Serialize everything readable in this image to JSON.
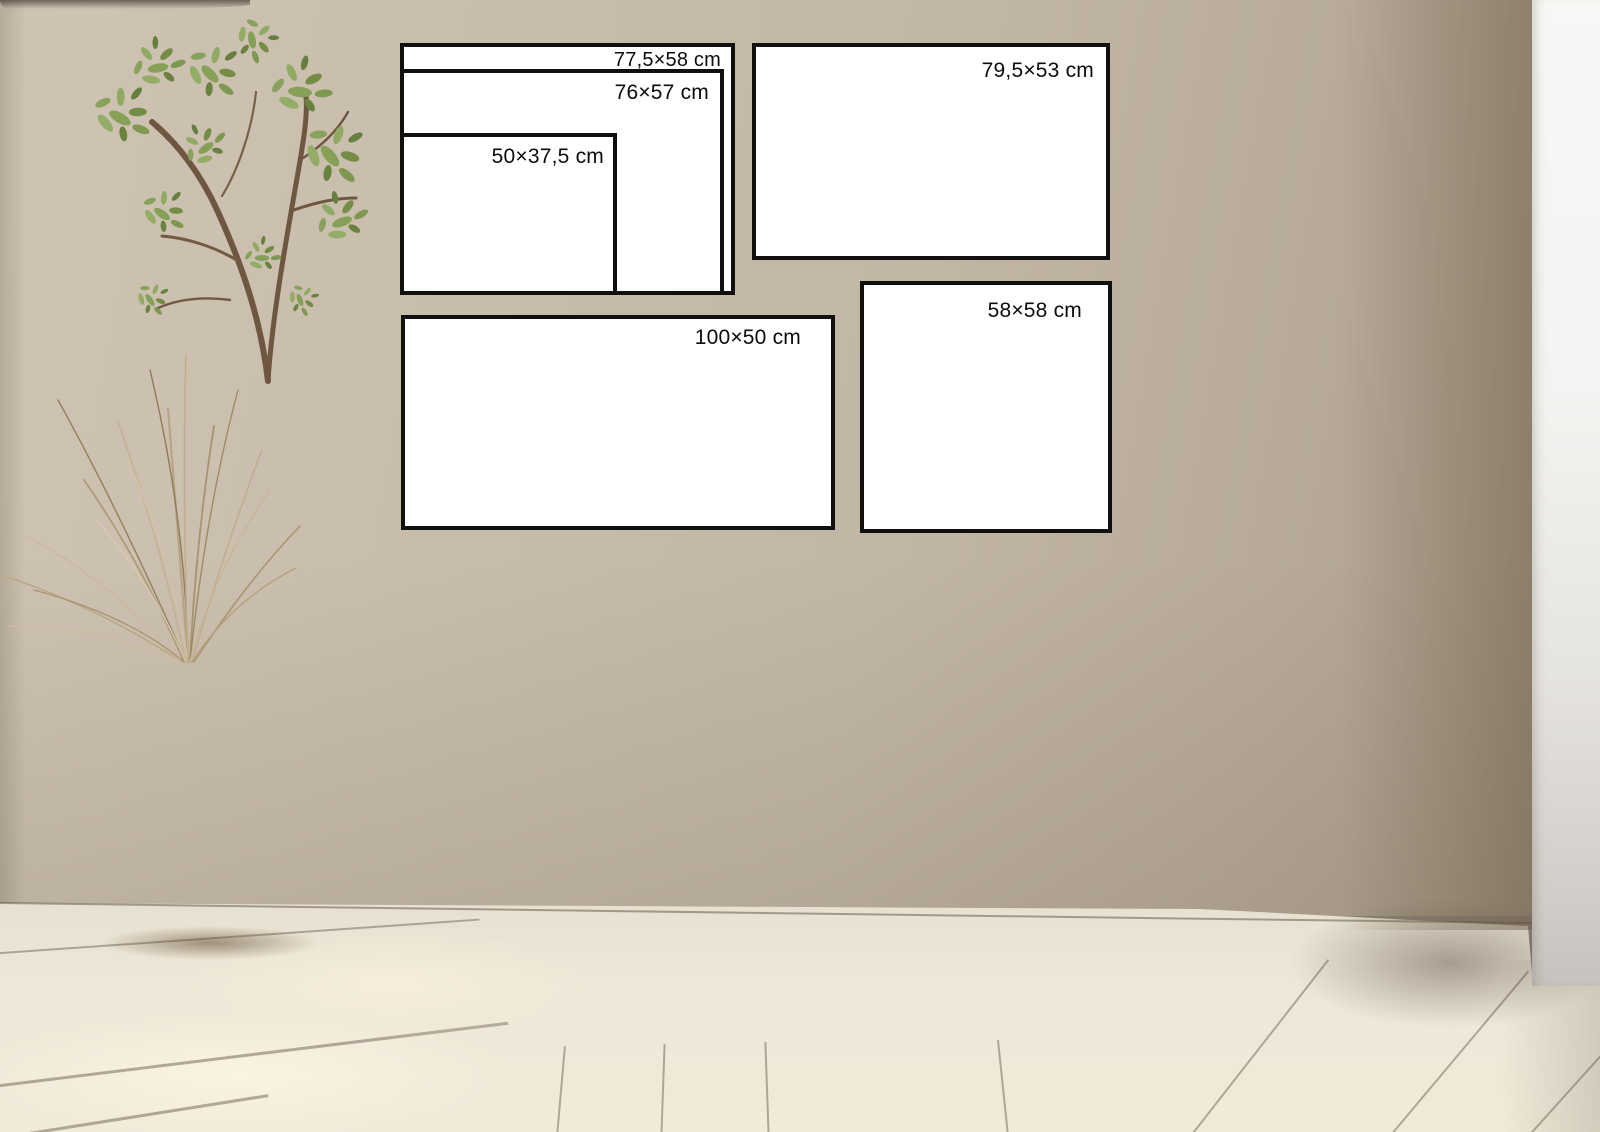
{
  "frames": {
    "frame_775x58": {
      "label": "77,5×58 cm"
    },
    "frame_76x57": {
      "label": "76×57 cm"
    },
    "frame_50x375": {
      "label": "50×37,5 cm"
    },
    "frame_795x53": {
      "label": "79,5×53 cm"
    },
    "frame_100x50": {
      "label": "100×50 cm"
    },
    "frame_58x58": {
      "label": "58×58 cm"
    }
  },
  "palette": {
    "wall": "#c2b6a5",
    "wall_shadow": "#a3947f",
    "white_wall_strip": "#f5f4f2",
    "floor": "#efe8d8",
    "frame_fill": "#ffffff",
    "frame_border": "#101010",
    "label_text": "#0c0c0c",
    "duvet": "#e0d7c5",
    "pillow_white": "#f8f7f5",
    "pillow_beige": "#d6ccba",
    "throw_knit": "#b0a496",
    "wicker_basket": "#b8874e",
    "dark_woven_vase": "#5f4933",
    "wood_stool": "#a9773d",
    "ceramic_white": "#f4f2ef",
    "vase_taupe": "#a89d8b",
    "dried_grass": "#c2b098",
    "foliage_green": "#7d9450"
  }
}
